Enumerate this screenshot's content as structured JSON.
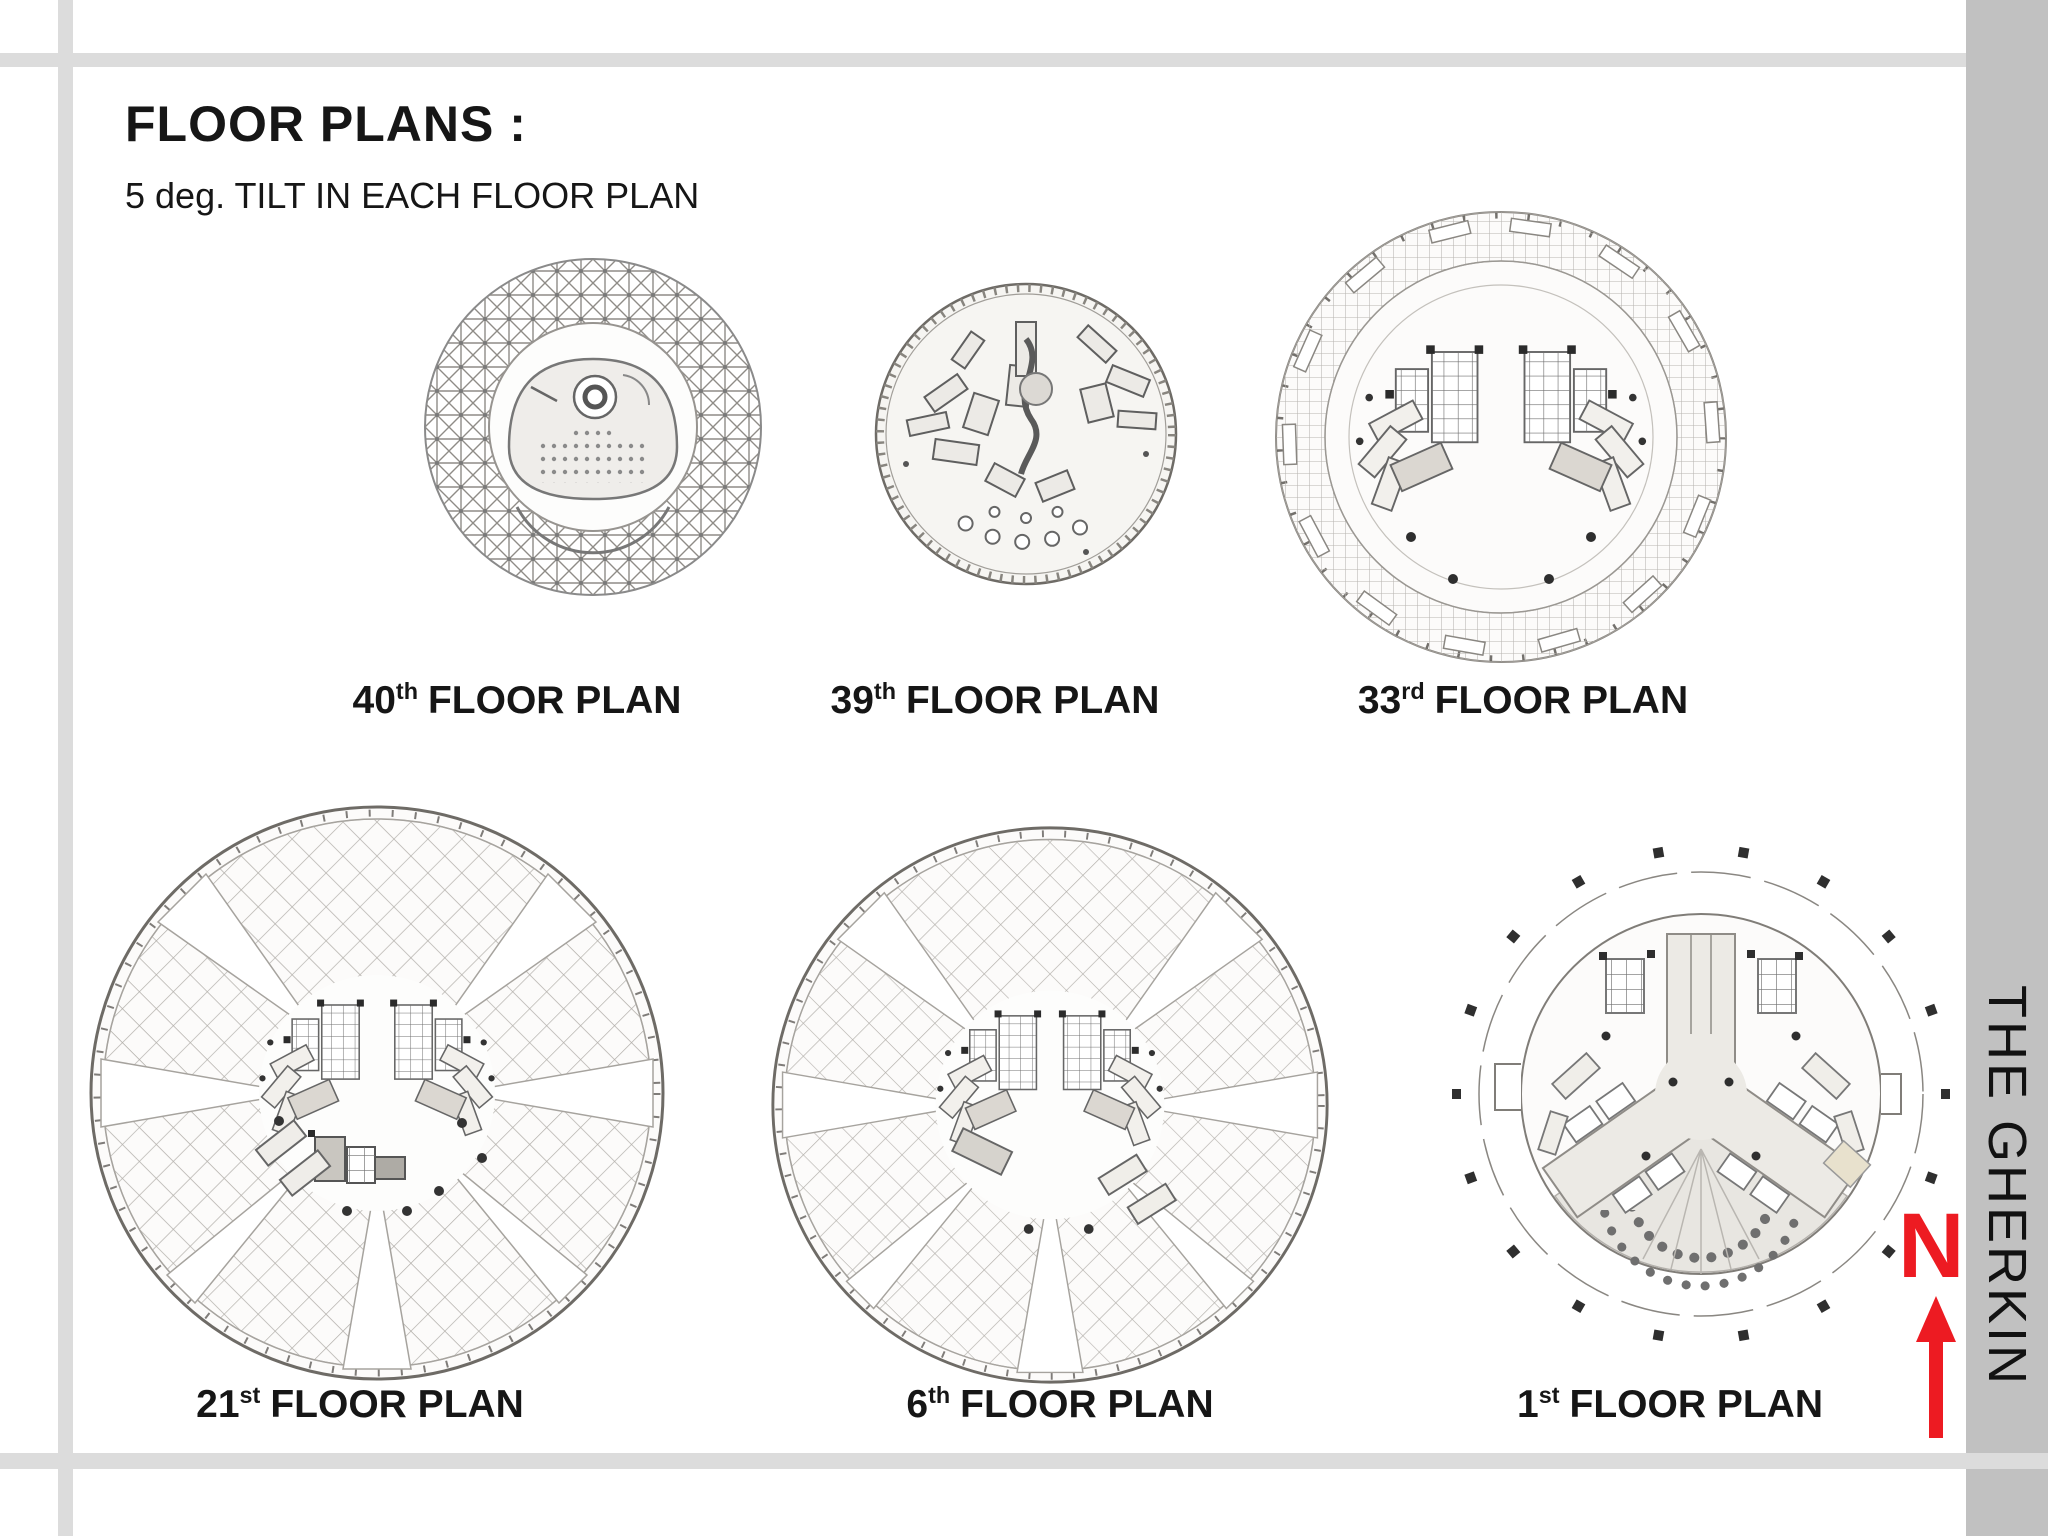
{
  "header": {
    "title": "FLOOR PLANS :",
    "subtitle": "5 deg. TILT IN EACH FLOOR PLAN"
  },
  "plans": [
    {
      "ordinal": "40",
      "suffix": "th",
      "caption": "FLOOR PLAN"
    },
    {
      "ordinal": "39",
      "suffix": "th",
      "caption": "FLOOR PLAN"
    },
    {
      "ordinal": "33",
      "suffix": "rd",
      "caption": "FLOOR PLAN"
    },
    {
      "ordinal": "21",
      "suffix": "st",
      "caption": "FLOOR PLAN"
    },
    {
      "ordinal": "6",
      "suffix": "th",
      "caption": "FLOOR PLAN"
    },
    {
      "ordinal": "1",
      "suffix": "st",
      "caption": "FLOOR PLAN"
    }
  ],
  "sidebar": {
    "building_name": "THE GHERKIN"
  },
  "north": {
    "label": "N"
  },
  "colors": {
    "frame_light": "#dcdcdc",
    "frame_side": "#c1c1c1",
    "accent_red": "#ed1b22",
    "ink": "#161616"
  }
}
